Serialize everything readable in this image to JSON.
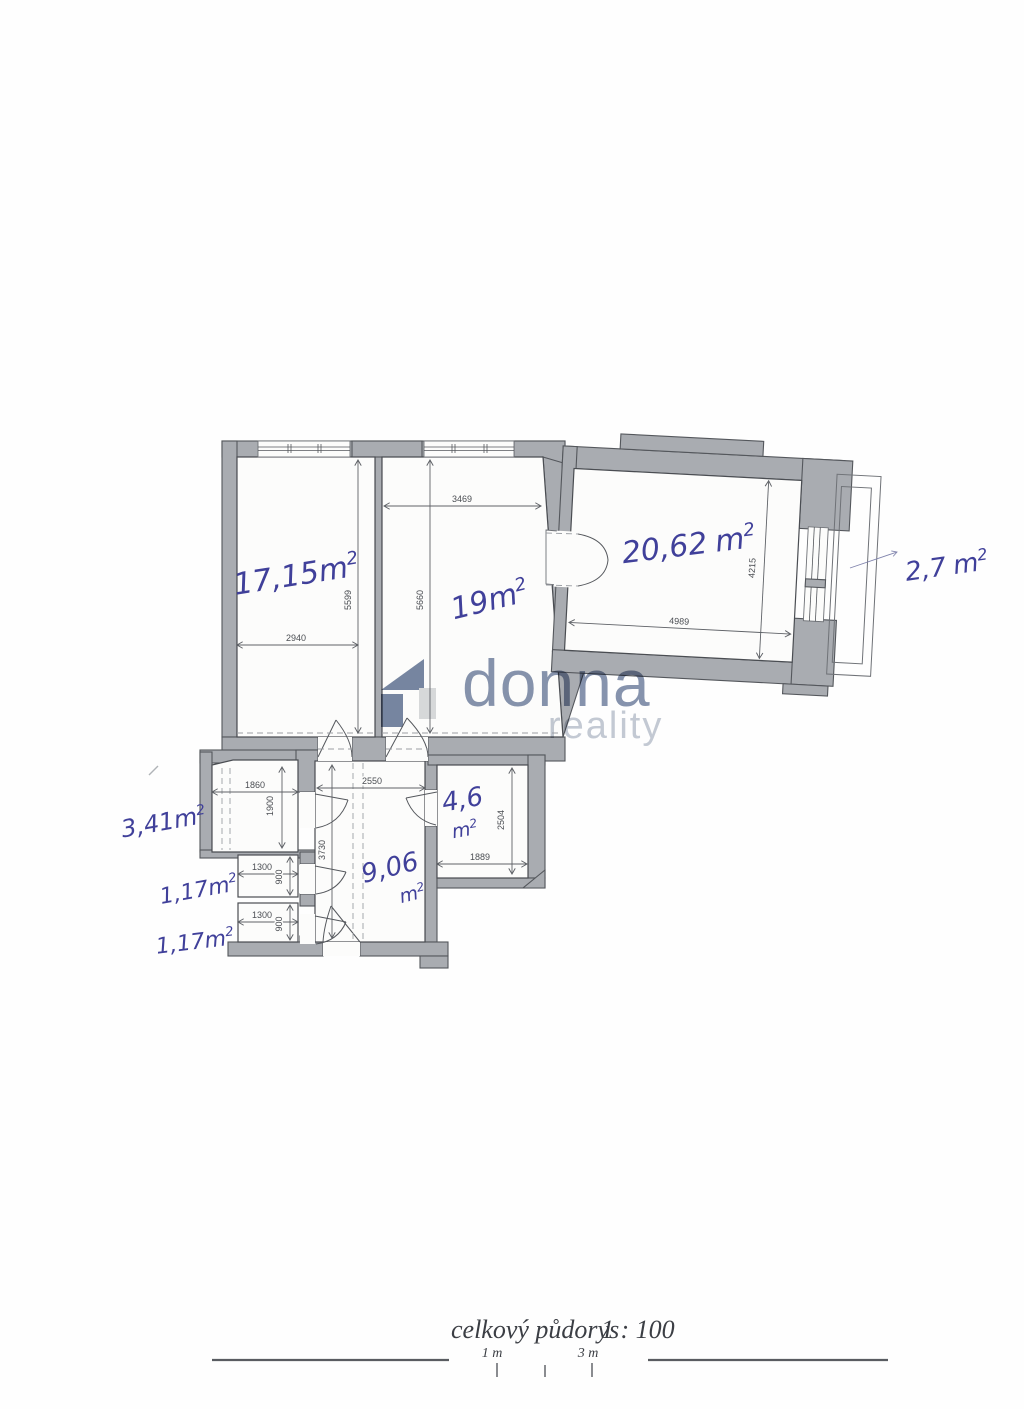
{
  "plan": {
    "rooms": [
      {
        "id": "room-17",
        "area": "17,15",
        "unit": "m",
        "sup": "2"
      },
      {
        "id": "room-19",
        "area": "19",
        "unit": "m",
        "sup": "2"
      },
      {
        "id": "room-20",
        "area": "20,62",
        "unit": "m",
        "sup": "2"
      },
      {
        "id": "balcony",
        "area": "2,7",
        "unit": "m",
        "sup": "2"
      },
      {
        "id": "closet",
        "area": "3,41",
        "unit": "m",
        "sup": "2"
      },
      {
        "id": "wc-upper",
        "area": "1,17",
        "unit": "m",
        "sup": "2"
      },
      {
        "id": "wc-lower",
        "area": "1,17",
        "unit": "m",
        "sup": "2"
      },
      {
        "id": "pantry",
        "area": "4,6",
        "unit": "m",
        "sup": "2"
      },
      {
        "id": "hall",
        "area": "9,06",
        "unit": "m",
        "sup": "2"
      }
    ],
    "dimensions_mm": {
      "room17_width": "2940",
      "room17_height": "5599",
      "room19_top": "3469",
      "room19_height": "5660",
      "room20_width": "4989",
      "room20_height": "4215",
      "closet_width": "1860",
      "closet_height": "1900",
      "hall_width": "2550",
      "hall_height": "3730",
      "wc_upper_width": "1300",
      "wc_upper_height": "900",
      "wc_lower_width": "1300",
      "wc_lower_height": "900",
      "pantry_width": "1889",
      "pantry_height": "2504"
    }
  },
  "watermark": {
    "brand": "donna",
    "subtitle": "reality"
  },
  "footer": {
    "caption": "celkový půdorys",
    "scale": "1 : 100",
    "scale_labels": [
      "1 m",
      "3 m"
    ]
  },
  "colors": {
    "ink": "#40409a",
    "wall": "#a9acb1",
    "outline": "#54575c",
    "watermark_brand": "#8794ae",
    "watermark_subtitle": "#c4cad4",
    "logo_dark": "#7787a3",
    "logo_light": "#d9dbdd"
  }
}
